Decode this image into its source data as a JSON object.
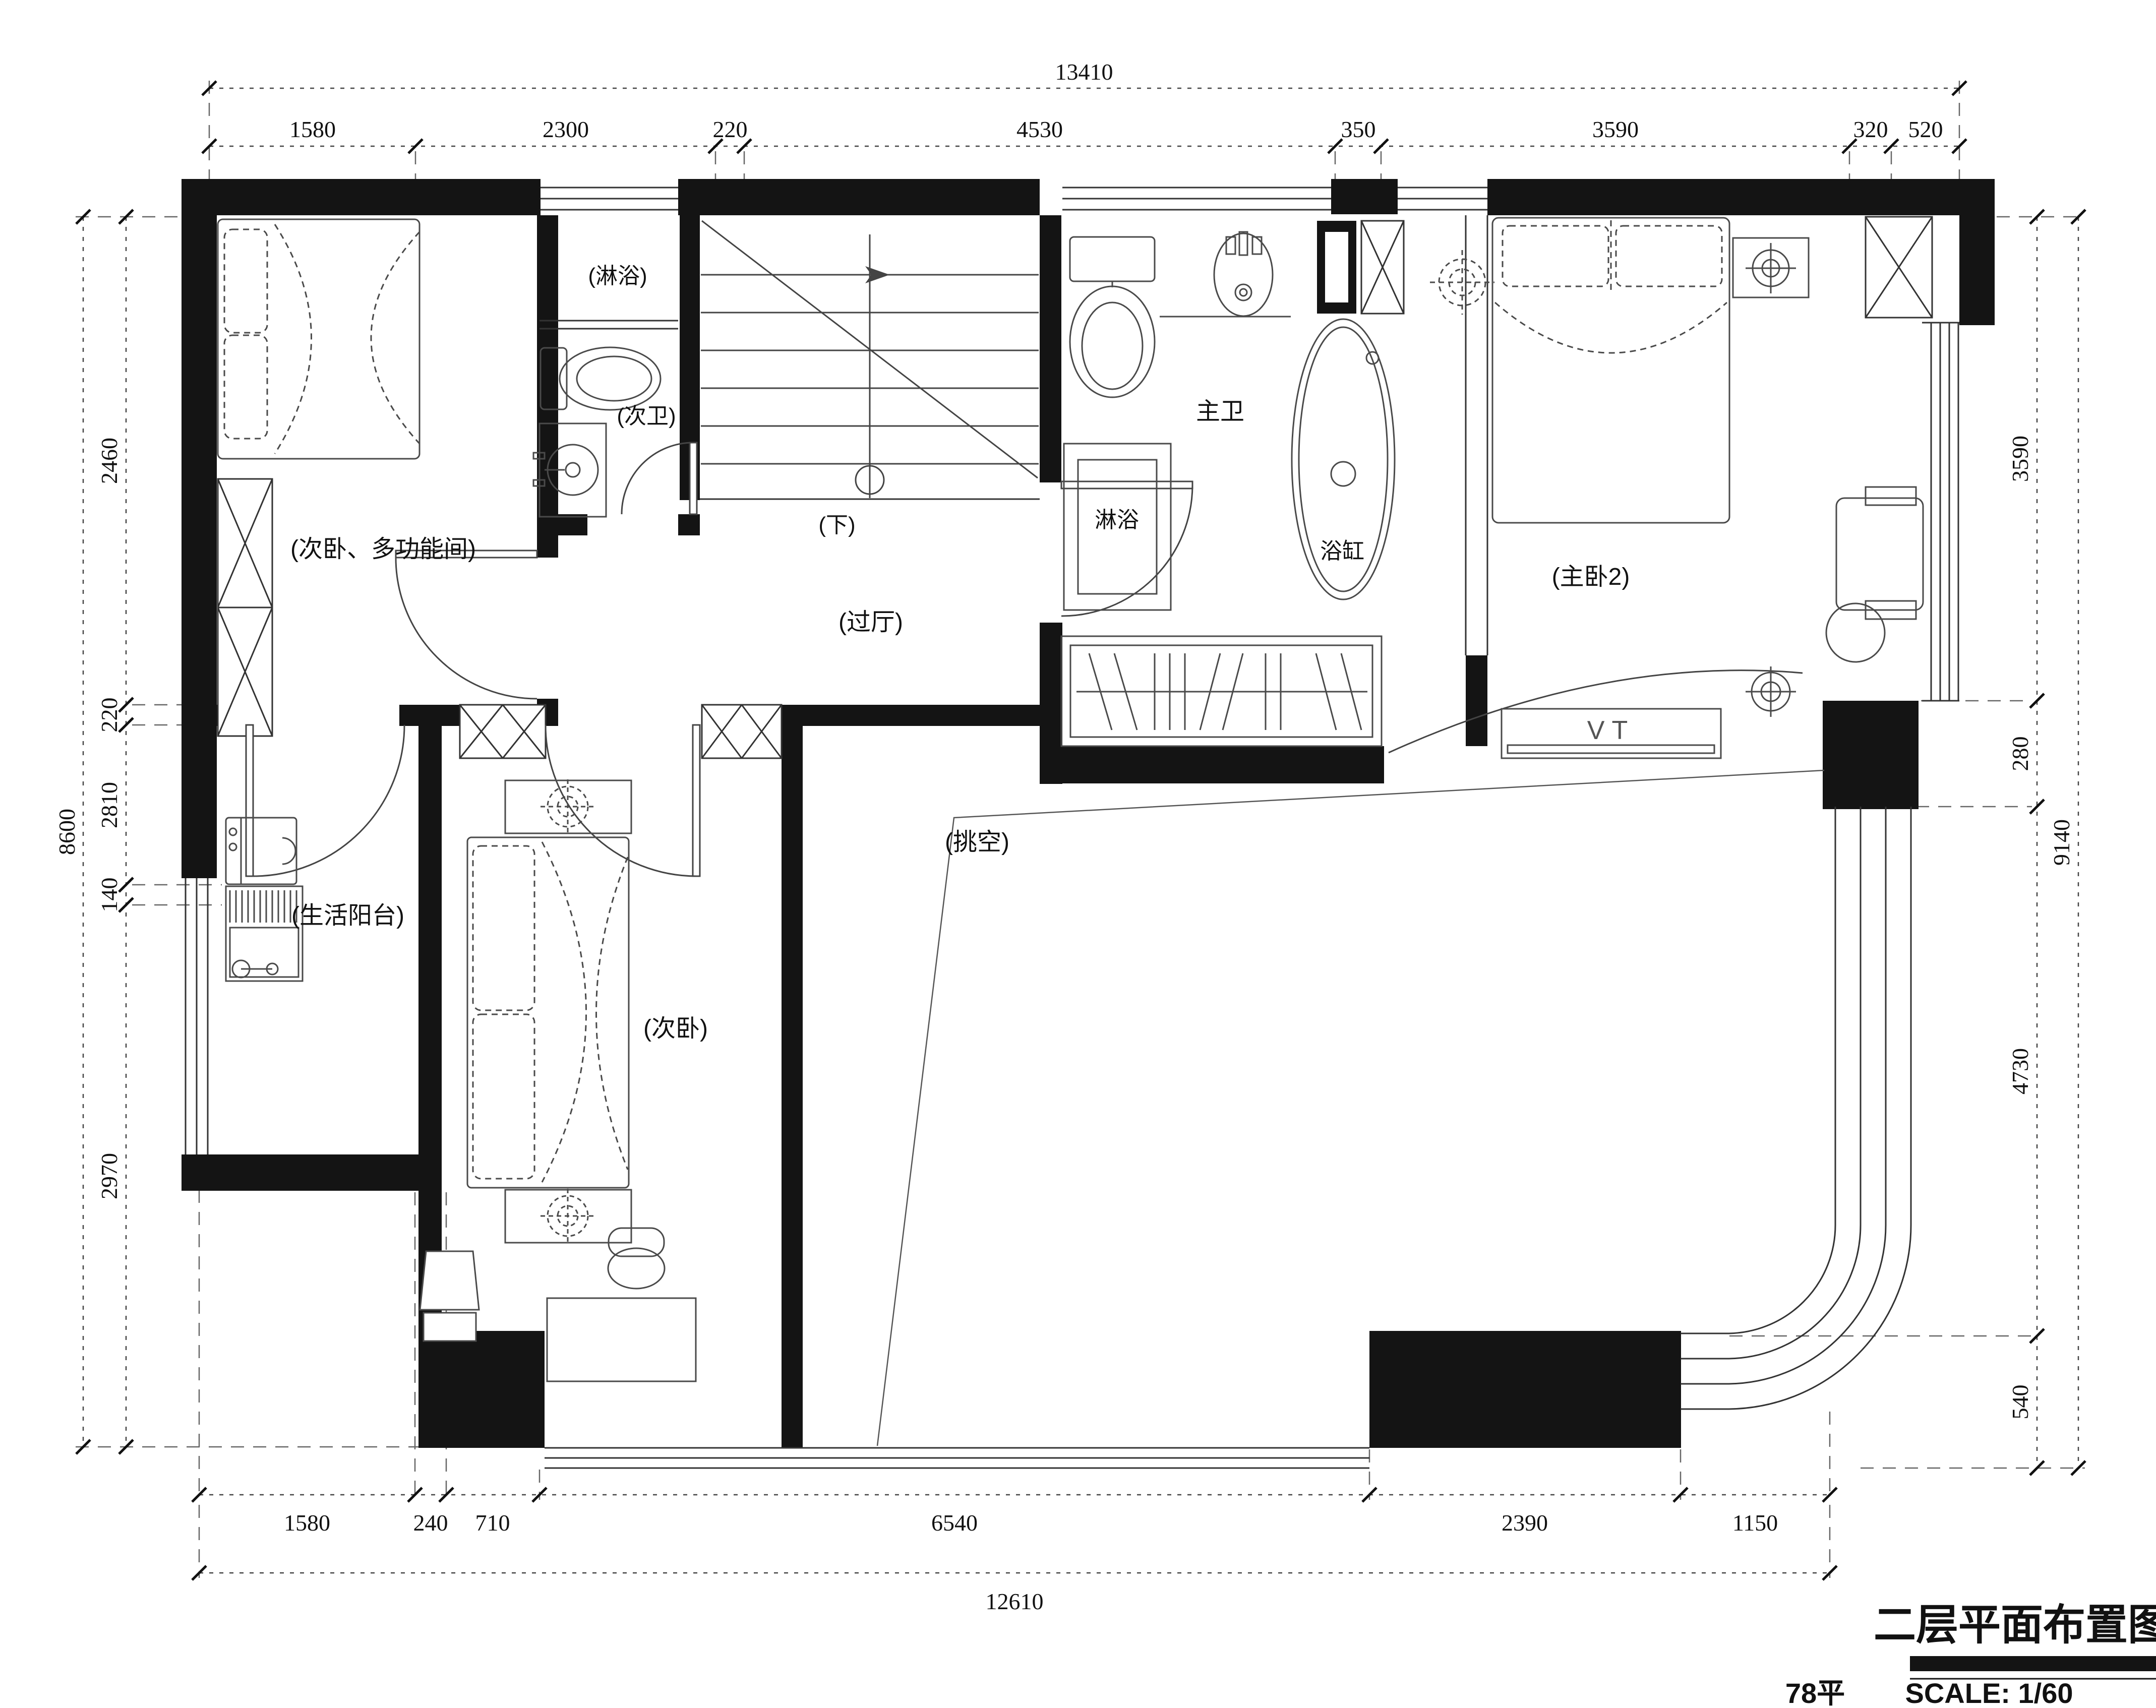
{
  "drawing": {
    "title": "二层平面布置图",
    "area": "78平",
    "scale": "SCALE: 1/60"
  },
  "rooms": {
    "multi_bedroom": "(次卧、多功能间)",
    "shower_nook": "(淋浴)",
    "second_bath": "(次卫)",
    "stairs_down": "(下)",
    "hallway": "(过厅)",
    "master_bath": "主卫",
    "master_shower": "淋浴",
    "bathtub": "浴缸",
    "master_bedroom": "(主卧2)",
    "balcony": "(生活阳台)",
    "second_bedroom": "(次卧)",
    "void_space": "(挑空)",
    "tv_cabinet": "VT"
  },
  "dimensions": {
    "top": {
      "total": "13410",
      "segments": [
        "1580",
        "2300",
        "220",
        "4530",
        "350",
        "3590",
        "320",
        "520"
      ]
    },
    "left": {
      "total": "8600",
      "segments": [
        "2460",
        "220",
        "2810",
        "140",
        "2970"
      ]
    },
    "right": {
      "total": "9140",
      "segments": [
        "3590",
        "280",
        "4730",
        "540"
      ]
    },
    "bottom": {
      "total": "12610",
      "segments": [
        "1580",
        "240",
        "710",
        "6540",
        "2390",
        "1150"
      ]
    }
  }
}
